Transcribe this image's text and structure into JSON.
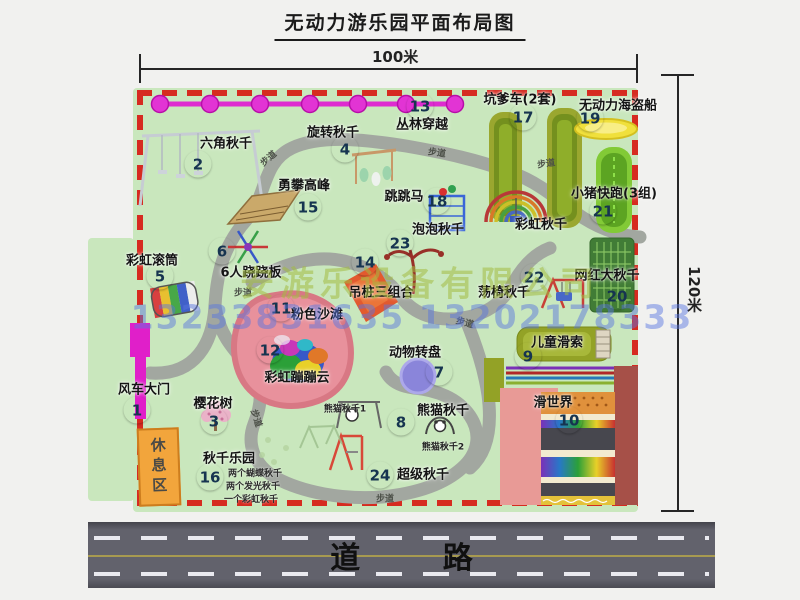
{
  "title": "无动力游乐园平面布局图",
  "dimensions": {
    "width": "100米",
    "height": "120米"
  },
  "road": {
    "label": "道 路"
  },
  "watermark": {
    "company": "安游乐设备有限公司",
    "phone": "13233831635 13202178333"
  },
  "rest_area_label": "休息区",
  "trail_label": "步道",
  "attractions": [
    {
      "num": "1",
      "name": "风车大门"
    },
    {
      "num": "2",
      "name": "六角秋千"
    },
    {
      "num": "3",
      "name": "樱花树"
    },
    {
      "num": "4",
      "name": "旋转秋千"
    },
    {
      "num": "5",
      "name": "彩虹滚筒"
    },
    {
      "num": "6",
      "name": "6人跷跷板"
    },
    {
      "num": "7",
      "name": "动物转盘"
    },
    {
      "num": "8",
      "name": "熊猫秋千"
    },
    {
      "num": "9",
      "name": "儿童滑索"
    },
    {
      "num": "10",
      "name": "滑世界"
    },
    {
      "num": "11",
      "name": "粉色沙滩"
    },
    {
      "num": "12",
      "name": "彩虹蹦蹦云"
    },
    {
      "num": "13",
      "name": "丛林穿越"
    },
    {
      "num": "14",
      "name": "吊桩三组合"
    },
    {
      "num": "15",
      "name": "勇攀高峰"
    },
    {
      "num": "16",
      "name": "秋千乐园"
    },
    {
      "num": "17",
      "name": "坑爹车(2套)"
    },
    {
      "num": "18",
      "name": "跳跳马"
    },
    {
      "num": "19",
      "name": "无动力海盗船"
    },
    {
      "num": "20",
      "name": "网红大秋千"
    },
    {
      "num": "21",
      "name": "小猪快跑(3组)"
    },
    {
      "num": "22",
      "name": "荡椅秋千"
    },
    {
      "num": "23",
      "name": "泡泡秋千"
    },
    {
      "num": "24",
      "name": "超级秋千"
    }
  ],
  "extra_labels": {
    "rainbow_swing": "彩虹秋千",
    "panda_swing_1": "熊猫秋千1",
    "panda_swing_2": "熊猫秋千2",
    "swing_park_notes": [
      "两个蝴蝶秋千",
      "两个发光秋千",
      "一个彩虹秋千"
    ]
  },
  "colors": {
    "park_green": "#c9e7bd",
    "border_red": "#d62b20",
    "badge_teal": "#23c6ba",
    "gate_magenta": "#e01fc9",
    "rest_area_orange": "#f2a53c",
    "road_gray": "#62626c"
  }
}
